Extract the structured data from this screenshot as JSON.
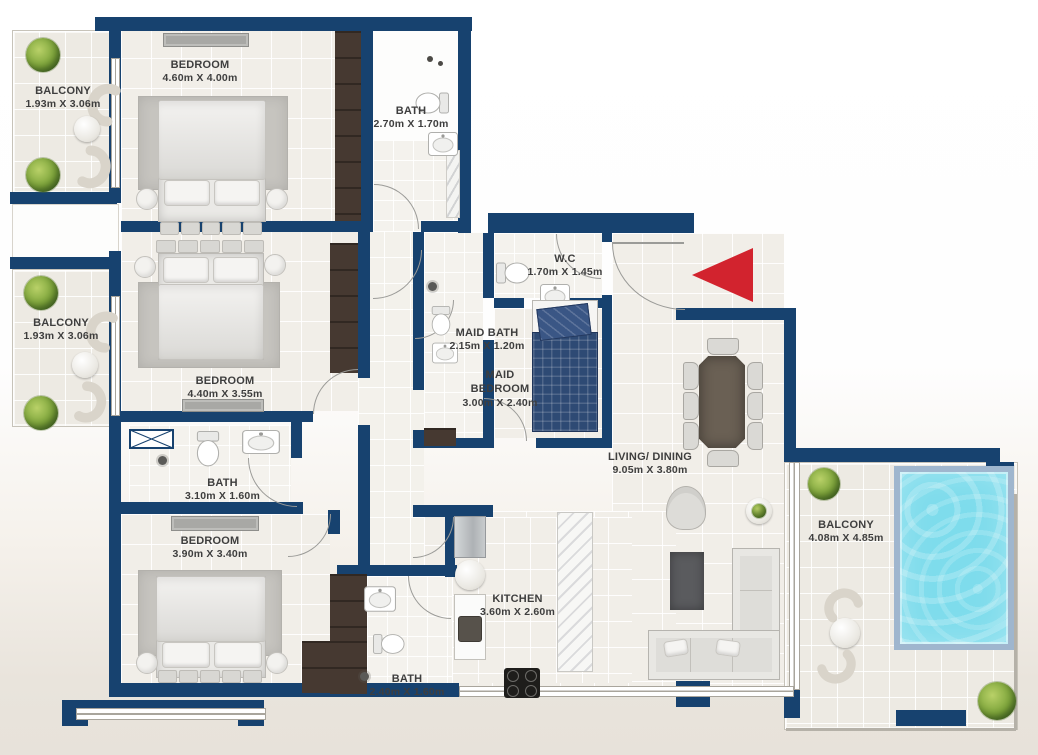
{
  "colors": {
    "wall": "#17426f",
    "accent_red": "#d2232e",
    "pool": "#7edcec",
    "wood": "#463931"
  },
  "rooms": [
    {
      "name": "BALCONY",
      "dims": "1.93m X 3.06m"
    },
    {
      "name": "BEDROOM",
      "dims": "4.60m X 4.00m"
    },
    {
      "name": "BATH",
      "dims": "2.70m X 1.70m"
    },
    {
      "name": "BALCONY",
      "dims": "1.93m X 3.06m"
    },
    {
      "name": "BEDROOM",
      "dims": "4.40m X 3.55m"
    },
    {
      "name": "W.C",
      "dims": "1.70m X 1.45m"
    },
    {
      "name": "MAID BATH",
      "dims": "2.15m X 1.20m"
    },
    {
      "name": "MAID BEDROOM",
      "dims": "3.00m X 2.40m"
    },
    {
      "name": "LIVING/ DINING",
      "dims": "9.05m X 3.80m"
    },
    {
      "name": "BATH",
      "dims": "3.10m X 1.60m"
    },
    {
      "name": "BEDROOM",
      "dims": "3.90m X 3.40m"
    },
    {
      "name": "BATH",
      "dims": "2.40m X 1.60m"
    },
    {
      "name": "KITCHEN",
      "dims": "3.60m X 2.60m"
    },
    {
      "name": "BALCONY",
      "dims": "4.08m X 4.85m"
    }
  ]
}
